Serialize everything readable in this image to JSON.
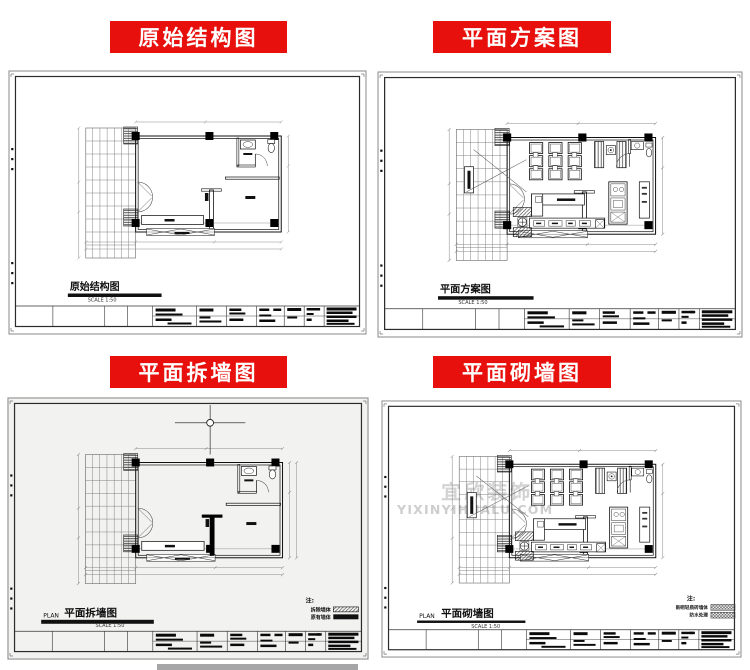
{
  "banners": {
    "original": "原始结构图",
    "scheme": "平面方案图",
    "demolish": "平面拆墙图",
    "build": "平面砌墙图"
  },
  "sheets": {
    "original": {
      "title": "原始结构图",
      "scale": "SCALE 1:50"
    },
    "scheme": {
      "title": "平面方案图",
      "scale": "SCALE 1:50"
    },
    "demolish": {
      "plan_prefix": "PLAN",
      "title": "平面拆墙图",
      "scale": "SCALE 1:50",
      "legend": {
        "note": "注:",
        "items": [
          {
            "label": "拆除墙体"
          },
          {
            "label": "原有墙体"
          }
        ]
      }
    },
    "build": {
      "plan_prefix": "PLAN",
      "title": "平面砌墙图",
      "scale": "SCALE 1:50",
      "legend": {
        "note": "注:",
        "items": [
          {
            "label": "新砌轻质砖墙体"
          },
          {
            "label": "防水处理"
          }
        ]
      },
      "watermark": {
        "line1": "宜欣装饰",
        "line2": "YIXINYIHUALU.COM"
      }
    }
  },
  "colors": {
    "banner_red": "#e8100c",
    "paper_gray": "#f2f2f1"
  }
}
